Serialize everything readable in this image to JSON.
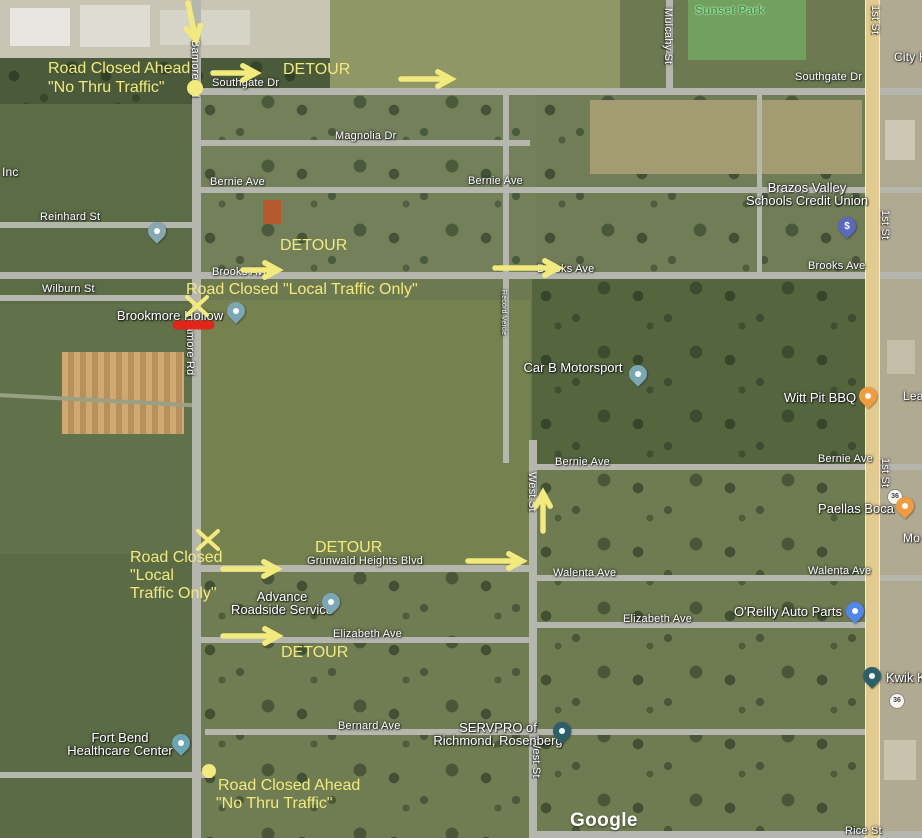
{
  "attribution": {
    "google_logo": "Google"
  },
  "colors": {
    "annotation_yellow": "#f2ea7d",
    "closure_red": "#e1251b",
    "highway_yellow": "#e2cb8e",
    "road_gray": "#b5b7ae",
    "park_label_green": "#3f9d47",
    "map_label_white": "#ffffff"
  },
  "streets": {
    "labels": [
      {
        "t": "Southgate Dr",
        "x": 212,
        "y": 77
      },
      {
        "t": "Southgate Dr",
        "x": 795,
        "y": 71
      },
      {
        "t": "Magnolia Dr",
        "x": 335,
        "y": 130
      },
      {
        "t": "Bernie Ave",
        "x": 210,
        "y": 176
      },
      {
        "t": "Bernie Ave",
        "x": 468,
        "y": 175
      },
      {
        "t": "Reinhard St",
        "x": 40,
        "y": 211
      },
      {
        "t": "Wilburn St",
        "x": 42,
        "y": 283
      },
      {
        "t": "Brooks Ave",
        "x": 212,
        "y": 266
      },
      {
        "t": "Brooks Ave",
        "x": 537,
        "y": 263
      },
      {
        "t": "Brooks Ave",
        "x": 808,
        "y": 260
      },
      {
        "t": "Bernie Ave",
        "x": 555,
        "y": 456
      },
      {
        "t": "Bernie Ave",
        "x": 818,
        "y": 453
      },
      {
        "t": "Walenta Ave",
        "x": 553,
        "y": 567
      },
      {
        "t": "Walenta Ave",
        "x": 808,
        "y": 565
      },
      {
        "t": "Grunwald Heights Blvd",
        "x": 307,
        "y": 555
      },
      {
        "t": "Elizabeth Ave",
        "x": 333,
        "y": 628
      },
      {
        "t": "Elizabeth Ave",
        "x": 623,
        "y": 613
      },
      {
        "t": "Bernard Ave",
        "x": 338,
        "y": 720
      },
      {
        "t": "Rice St",
        "x": 845,
        "y": 825
      },
      {
        "t": "Mulcahy St",
        "x": 662,
        "y": 8,
        "v": true
      },
      {
        "t": "1st St",
        "x": 869,
        "y": 5,
        "v": true
      },
      {
        "t": "1st St",
        "x": 879,
        "y": 210,
        "v": true
      },
      {
        "t": "1st St",
        "x": 879,
        "y": 458,
        "v": true
      },
      {
        "t": "West St",
        "x": 526,
        "y": 472,
        "v": true
      },
      {
        "t": "West St",
        "x": 530,
        "y": 738,
        "v": true
      },
      {
        "t": "Bamore Rd",
        "x": 189,
        "y": 40,
        "v": true
      },
      {
        "t": "Bamore Rd",
        "x": 184,
        "y": 318,
        "v": true
      },
      {
        "t": "Record Verde",
        "x": 500,
        "y": 290,
        "v": true,
        "size": 7
      }
    ]
  },
  "parks": [
    {
      "t": "Sunset Park",
      "x": 695,
      "y": 3
    }
  ],
  "partials": [
    {
      "t": "Inc",
      "x": 2,
      "y": 165
    },
    {
      "t": "City H",
      "x": 894,
      "y": 50
    },
    {
      "t": "Lea",
      "x": 903,
      "y": 389
    },
    {
      "t": "Mo",
      "x": 903,
      "y": 531
    }
  ],
  "pois": [
    {
      "id": "brazos-valley-schools-credit-union",
      "lines": [
        "Brazos Valley",
        "Schools Credit Union"
      ],
      "cx": 807,
      "y": 180,
      "pin": {
        "cx": 847,
        "ty": 240,
        "color": "#5a68bd",
        "glyph": "$"
      }
    },
    {
      "id": "car-b-motorsport",
      "lines": [
        "Car B Motorsport"
      ],
      "cx": 573,
      "y": 360,
      "pin": {
        "cx": 638,
        "ty": 388,
        "color": "#7ba7b4"
      }
    },
    {
      "id": "witt-pit-bbq",
      "lines": [
        "Witt Pit BBQ"
      ],
      "cx": 820,
      "y": 390,
      "pin": {
        "cx": 868,
        "ty": 410,
        "color": "#f09b3f"
      }
    },
    {
      "id": "paellas-boca",
      "lines": [
        "Paellas Boca"
      ],
      "cx": 856,
      "y": 501,
      "pin": {
        "cx": 905,
        "ty": 520,
        "color": "#f09b3f"
      }
    },
    {
      "id": "oreilly-auto-parts",
      "lines": [
        "O'Reilly Auto Parts"
      ],
      "cx": 788,
      "y": 604,
      "pin": {
        "cx": 855,
        "ty": 625,
        "color": "#5186ec"
      }
    },
    {
      "id": "advance-roadside-service",
      "lines": [
        "Advance",
        "Roadside Service"
      ],
      "cx": 282,
      "y": 589,
      "pin": {
        "cx": 331,
        "ty": 616,
        "color": "#7ba7b4"
      }
    },
    {
      "id": "servpro-of-richmond-rosenberg",
      "lines": [
        "SERVPRO of",
        "Richmond, Rosenberg"
      ],
      "cx": 498,
      "y": 720,
      "pin": {
        "cx": 562,
        "ty": 745,
        "color": "#2d5f6b"
      }
    },
    {
      "id": "fort-bend-healthcare-center",
      "lines": [
        "Fort Bend",
        "Healthcare Center"
      ],
      "cx": 120,
      "y": 730,
      "pin": {
        "cx": 181,
        "ty": 757,
        "color": "#69a5b2"
      }
    },
    {
      "id": "brookmore-hollow",
      "lines": [
        "Brookmore Hollow"
      ],
      "cx": 170,
      "y": 308,
      "pin": {
        "cx": 236,
        "ty": 325,
        "color": "#7ba7b4"
      }
    },
    {
      "id": "school",
      "lines": [],
      "cx": 157,
      "y": 220,
      "pin": {
        "cx": 157,
        "ty": 245,
        "color": "#87a8b2"
      }
    },
    {
      "id": "kwik-k",
      "lines": [
        "Kwik K"
      ],
      "cx": 886,
      "y": 670,
      "align": "left",
      "pin": {
        "cx": 872,
        "ty": 690,
        "color": "#2d5f6b"
      }
    }
  ],
  "annotations": {
    "color": "#f2ea7d",
    "texts": [
      {
        "t": "Road Closed Ahead",
        "x": 48,
        "y": 60
      },
      {
        "t": "\"No Thru Traffic\"",
        "x": 48,
        "y": 79
      },
      {
        "t": "DETOUR",
        "x": 283,
        "y": 61
      },
      {
        "t": "DETOUR",
        "x": 280,
        "y": 237
      },
      {
        "t": "Road Closed \"Local Traffic Only\"",
        "x": 186,
        "y": 281
      },
      {
        "t": "Road Closed",
        "x": 130,
        "y": 549
      },
      {
        "t": "\"Local",
        "x": 130,
        "y": 567
      },
      {
        "t": "Traffic Only\"",
        "x": 130,
        "y": 585
      },
      {
        "t": "DETOUR",
        "x": 315,
        "y": 539
      },
      {
        "t": "DETOUR",
        "x": 281,
        "y": 644
      },
      {
        "t": "Road Closed Ahead",
        "x": 218,
        "y": 777
      },
      {
        "t": "\"No Thru Traffic\"",
        "x": 216,
        "y": 795
      }
    ],
    "arrows": [
      {
        "x1": 188,
        "y1": 3,
        "x2": 196,
        "y2": 40
      },
      {
        "x1": 213,
        "y1": 73,
        "x2": 256,
        "y2": 73
      },
      {
        "x1": 401,
        "y1": 79,
        "x2": 451,
        "y2": 79
      },
      {
        "x1": 243,
        "y1": 270,
        "x2": 278,
        "y2": 270
      },
      {
        "x1": 495,
        "y1": 268,
        "x2": 558,
        "y2": 268
      },
      {
        "x1": 223,
        "y1": 569,
        "x2": 277,
        "y2": 569
      },
      {
        "x1": 468,
        "y1": 561,
        "x2": 522,
        "y2": 561
      },
      {
        "x1": 543,
        "y1": 531,
        "x2": 543,
        "y2": 493
      },
      {
        "x1": 223,
        "y1": 636,
        "x2": 278,
        "y2": 636
      }
    ],
    "x_marks": [
      {
        "x": 197,
        "y": 306
      },
      {
        "x": 208,
        "y": 540
      }
    ],
    "dots": [
      {
        "x": 195,
        "y": 88,
        "r": 8
      },
      {
        "x": 209,
        "y": 771,
        "r": 7
      }
    ],
    "red_line": {
      "x1": 177,
      "y1": 325,
      "x2": 210,
      "y2": 325
    }
  },
  "shields": [
    {
      "t": "36",
      "x": 887,
      "y": 489
    },
    {
      "t": "36",
      "x": 889,
      "y": 693
    }
  ]
}
